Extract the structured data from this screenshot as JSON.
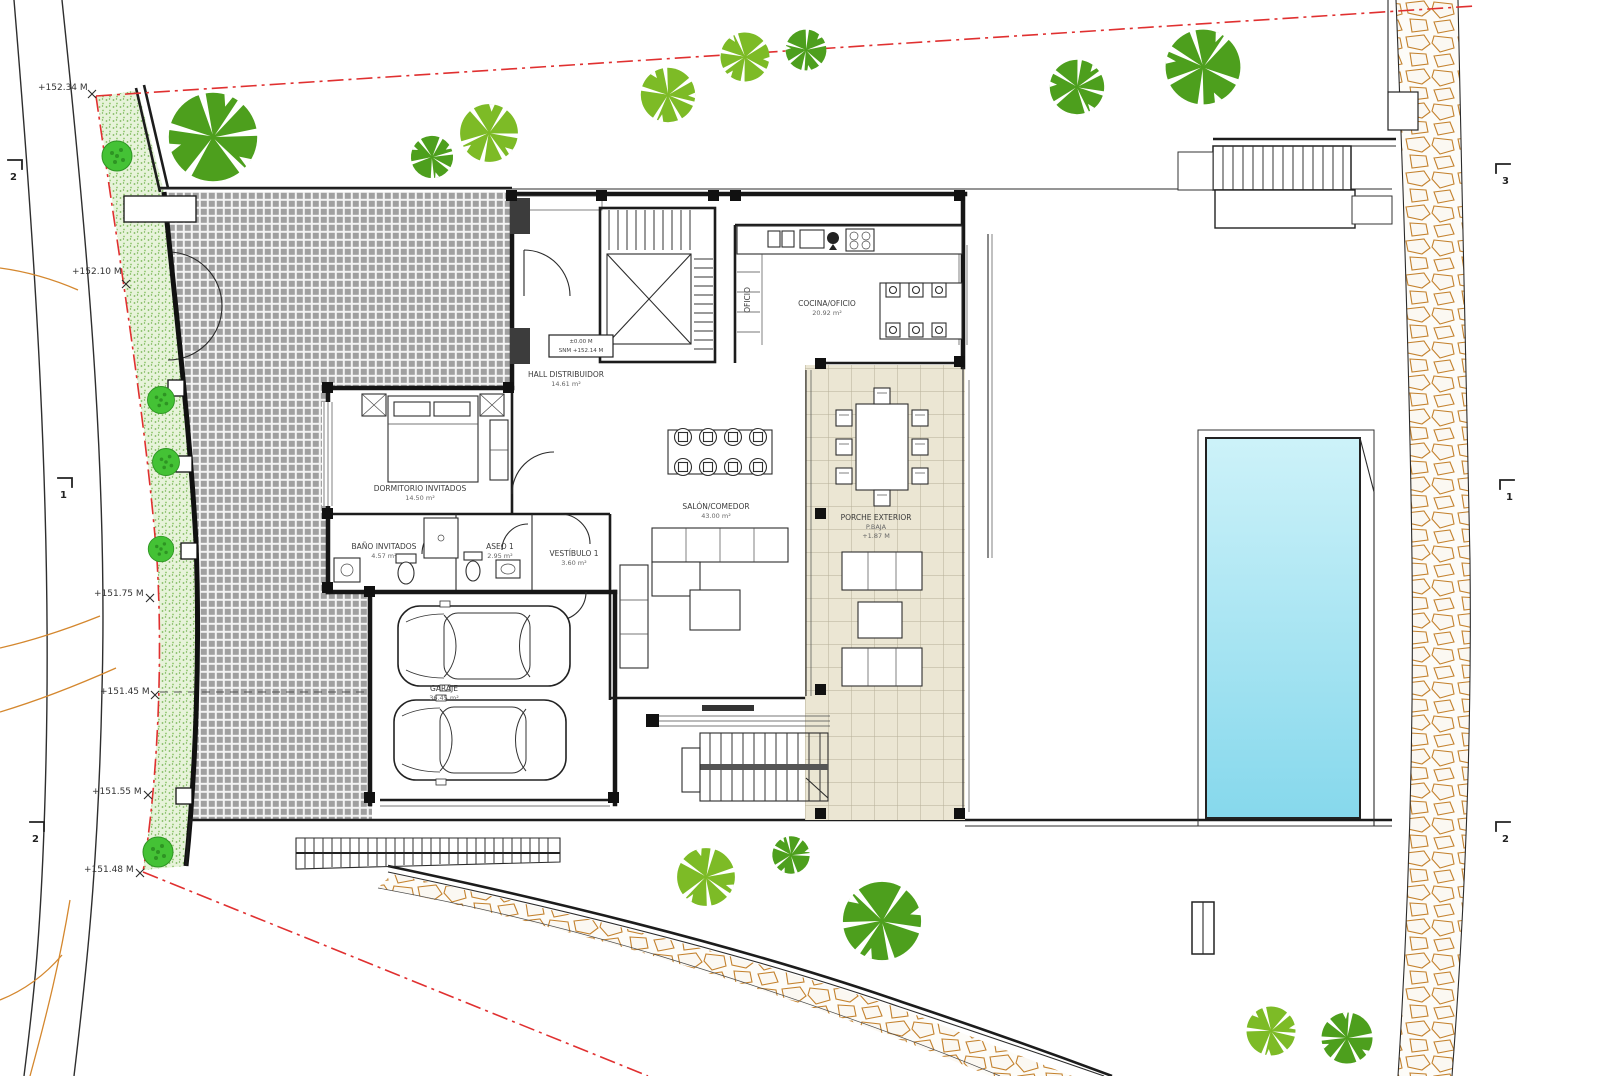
{
  "plan": {
    "type": "architectural-site-plan",
    "rooms": [
      {
        "name": "COCINA/OFICIO",
        "area": "20.92 m²"
      },
      {
        "name": "SALÓN/COMEDOR",
        "area": "43.00 m²"
      },
      {
        "name": "HALL DISTRIBUIDOR",
        "area": "14.61 m²"
      },
      {
        "name": "DORMITORIO INVITADOS",
        "area": "14.50 m²"
      },
      {
        "name": "BAÑO INVITADOS",
        "area": "4.57 m²"
      },
      {
        "name": "ASEO 1",
        "area": "2.95 m²"
      },
      {
        "name": "VESTÍBULO 1",
        "area": "3.60 m²"
      },
      {
        "name": "GARAJE",
        "area": "36.45 m²"
      },
      {
        "name": "PORCHE EXTERIOR",
        "sub": "P.BAJA",
        "area": "+1.87 M"
      },
      {
        "name": "OFICIO",
        "area": ""
      }
    ],
    "level_box": {
      "line1": "±0.00 M",
      "line2": "SNM +152.14 M"
    },
    "elevation_marks": [
      "+152.34 M",
      "+152.10 M",
      "+151.75 M",
      "+151.45 M",
      "+151.55 M",
      "+151.48 M"
    ],
    "section_marks": [
      "2",
      "1",
      "2",
      "3",
      "1",
      "2"
    ]
  },
  "colors": {
    "boundary-red": "#e03030",
    "contour-orange": "#d4872e",
    "tree-dark": "#4d9f1d",
    "tree-light": "#7dbb26",
    "bush-green": "#44c235",
    "pool-light": "#c6f0f8",
    "pool-deep": "#86d8ec",
    "paver-gray": "#a0a0a0",
    "tile-beige": "#ebe6d3",
    "grass-green": "#e7f3da",
    "stone-tan": "#c4822e"
  }
}
